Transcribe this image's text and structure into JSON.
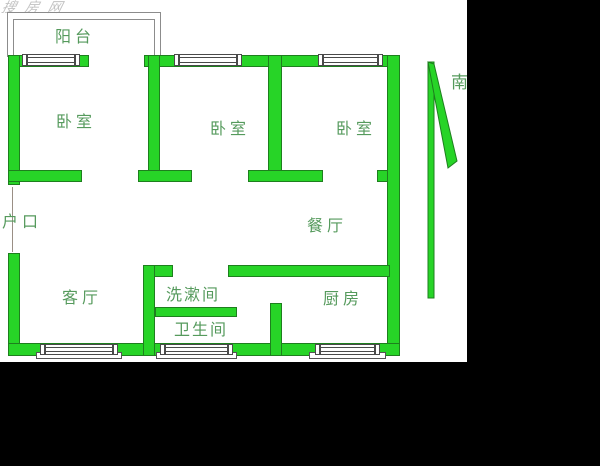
{
  "title": "apartment-floor-plan",
  "watermark": {
    "text": "搜房网"
  },
  "compass": {
    "label": "南"
  },
  "rooms": {
    "balcony": {
      "label": "阳台"
    },
    "bedroom1": {
      "label": "卧室"
    },
    "bedroom2": {
      "label": "卧室"
    },
    "bedroom3": {
      "label": "卧室"
    },
    "entrance": {
      "label": "户口"
    },
    "dining": {
      "label": "餐厅"
    },
    "living": {
      "label": "客厅"
    },
    "washroom": {
      "label": "洗漱间"
    },
    "bathroom": {
      "label": "卫生间"
    },
    "kitchen": {
      "label": "厨房"
    }
  },
  "colors": {
    "wall": "#27d427",
    "outline": "#1e7f1e",
    "label": "#559a5c",
    "balcony": "#8c8c8c",
    "frame": "#4a4a4a",
    "bg": "#000000",
    "paper": "#ffffff"
  }
}
